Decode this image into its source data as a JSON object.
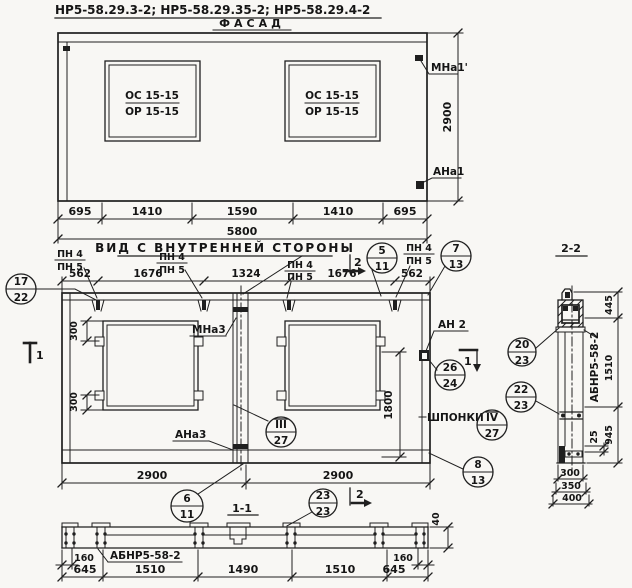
{
  "drawing_title": "НР5-58.29.3-2;  НР5-58.29.35-2;  НР5-58.29.4-2",
  "facade": {
    "label": "ФАСАД",
    "window_mark_top": "ОС 15-15",
    "window_mark_bottom": "ОР 15-15",
    "mark_top_right": "МНа1'",
    "mark_bottom_right": "АНа1",
    "dim_height": "2900",
    "dims_bottom": [
      "695",
      "1410",
      "1590",
      "1410",
      "695"
    ],
    "dim_total": "5800"
  },
  "inner_view": {
    "title": "ВИД С ВНУТРЕННЕЙ СТОРОНЫ",
    "pn_top": "ПН 4",
    "pn_bottom": "ПН 5",
    "dims_top": [
      "562",
      "1676",
      "1324",
      "1676",
      "562"
    ],
    "dim_window_offset": "300",
    "dim_opening_height": "1800",
    "dims_bottom": [
      "2900",
      "2900"
    ],
    "mark_mna3": "МНа3",
    "mark_ana3": "АНа3",
    "mark_an2": "АН 2",
    "label_keys": "ШПОНКИ",
    "cut_1": "1",
    "cut_2": "2"
  },
  "callouts": {
    "c17_22": {
      "top": "17",
      "bottom": "22"
    },
    "c5_11": {
      "top": "5",
      "bottom": "11"
    },
    "c7_13": {
      "top": "7",
      "bottom": "13"
    },
    "c26_24": {
      "top": "26",
      "bottom": "24"
    },
    "c3_27": {
      "top": "III",
      "bottom": "27"
    },
    "c4_27": {
      "top": "IV",
      "bottom": "27"
    },
    "c6_11": {
      "top": "6",
      "bottom": "11"
    },
    "c23_23": {
      "top": "23",
      "bottom": "23"
    },
    "c8_13": {
      "top": "8",
      "bottom": "13"
    },
    "c20_23": {
      "top": "20",
      "bottom": "23"
    },
    "c22_23": {
      "top": "22",
      "bottom": "23"
    }
  },
  "section_1_1": {
    "label": "1-1",
    "part_mark": "АБНР5-58-2",
    "dim_edge": "160",
    "dims_bottom": [
      "645",
      "1510",
      "1490",
      "1510",
      "645"
    ],
    "dim_thickness": "40"
  },
  "section_2_2": {
    "label": "2-2",
    "part_mark": "АБНР5-58-2",
    "dim_top": "445",
    "dim_middle": "1510",
    "dim_bottom": "945",
    "dim_offset": "25",
    "dims_width": [
      "300",
      "350",
      "400"
    ]
  },
  "colors": {
    "ink": "#1f1f1f",
    "paper": "#f8f7f4"
  }
}
